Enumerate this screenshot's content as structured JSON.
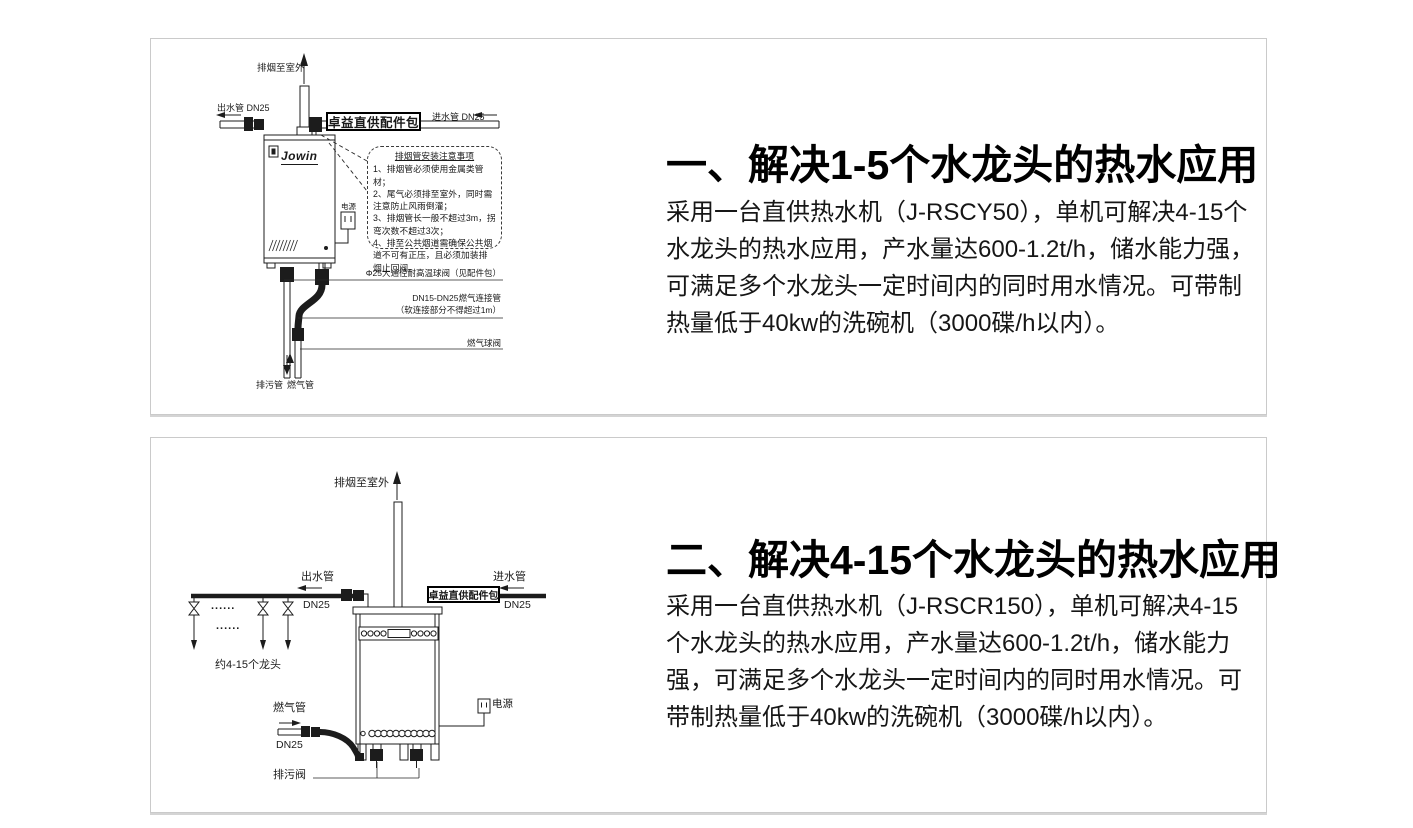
{
  "colors": {
    "panel_border": "#cacaca",
    "text": "#161616",
    "line_art": "#1c1c1c"
  },
  "panels": [
    {
      "heading": "一、解决1-5个水龙头的热水应用",
      "body": "采用一台直供热水机（J-RSCY50），单机可解决4-15个水龙头的热水应用，产水量达600-1.2t/h，储水能力强，可满足多个水龙头一定时间内的同时用水情况。可带制热量低于40kw的洗碗机（3000碟/h以内）。",
      "diagram": {
        "flue_label": "排烟至室外",
        "outlet_label": "出水管 DN25",
        "inlet_label": "进水管 DN25",
        "kit_label": "卓益直供配件包",
        "brand": "Jowin",
        "power_label": "电源",
        "notes_title": "排烟管安装注意事项",
        "notes": [
          "1、排烟管必须使用金属类管材；",
          "2、尾气必须排至室外，同时需注意防止风雨倒灌；",
          "3、排烟管长一般不超过3m，拐弯次数不超过3次；",
          "4、排至公共烟道需确保公共烟道不可有正压，且必须加装排烟止回阀。"
        ],
        "callout_ball_valve": "Φ25大通径耐高温球阀（见配件包）",
        "callout_gas_hose_1": "DN15-DN25燃气连接管",
        "callout_gas_hose_2": "（软连接部分不得超过1m）",
        "callout_gas_valve": "燃气球阀",
        "drain_label": "排污管",
        "gas_label": "燃气管"
      }
    },
    {
      "heading": "二、解决4-15个水龙头的热水应用",
      "body": "采用一台直供热水机（J-RSCR150），单机可解决4-15个水龙头的热水应用，产水量达600-1.2t/h，储水能力强，可满足多个水龙头一定时间内的同时用水情况。可带制热量低于40kw的洗碗机（3000碟/h以内）。",
      "diagram": {
        "flue_label": "排烟至室外",
        "outlet_label": "出水管",
        "outlet_dn": "DN25",
        "inlet_label": "进水管",
        "inlet_dn": "DN25",
        "kit_label": "卓益直供配件包",
        "taps_label": "约4-15个龙头",
        "dots": "......",
        "gas_label": "燃气管",
        "gas_dn": "DN25",
        "power_label": "电源",
        "drain_valve_label": "排污阀"
      }
    }
  ]
}
